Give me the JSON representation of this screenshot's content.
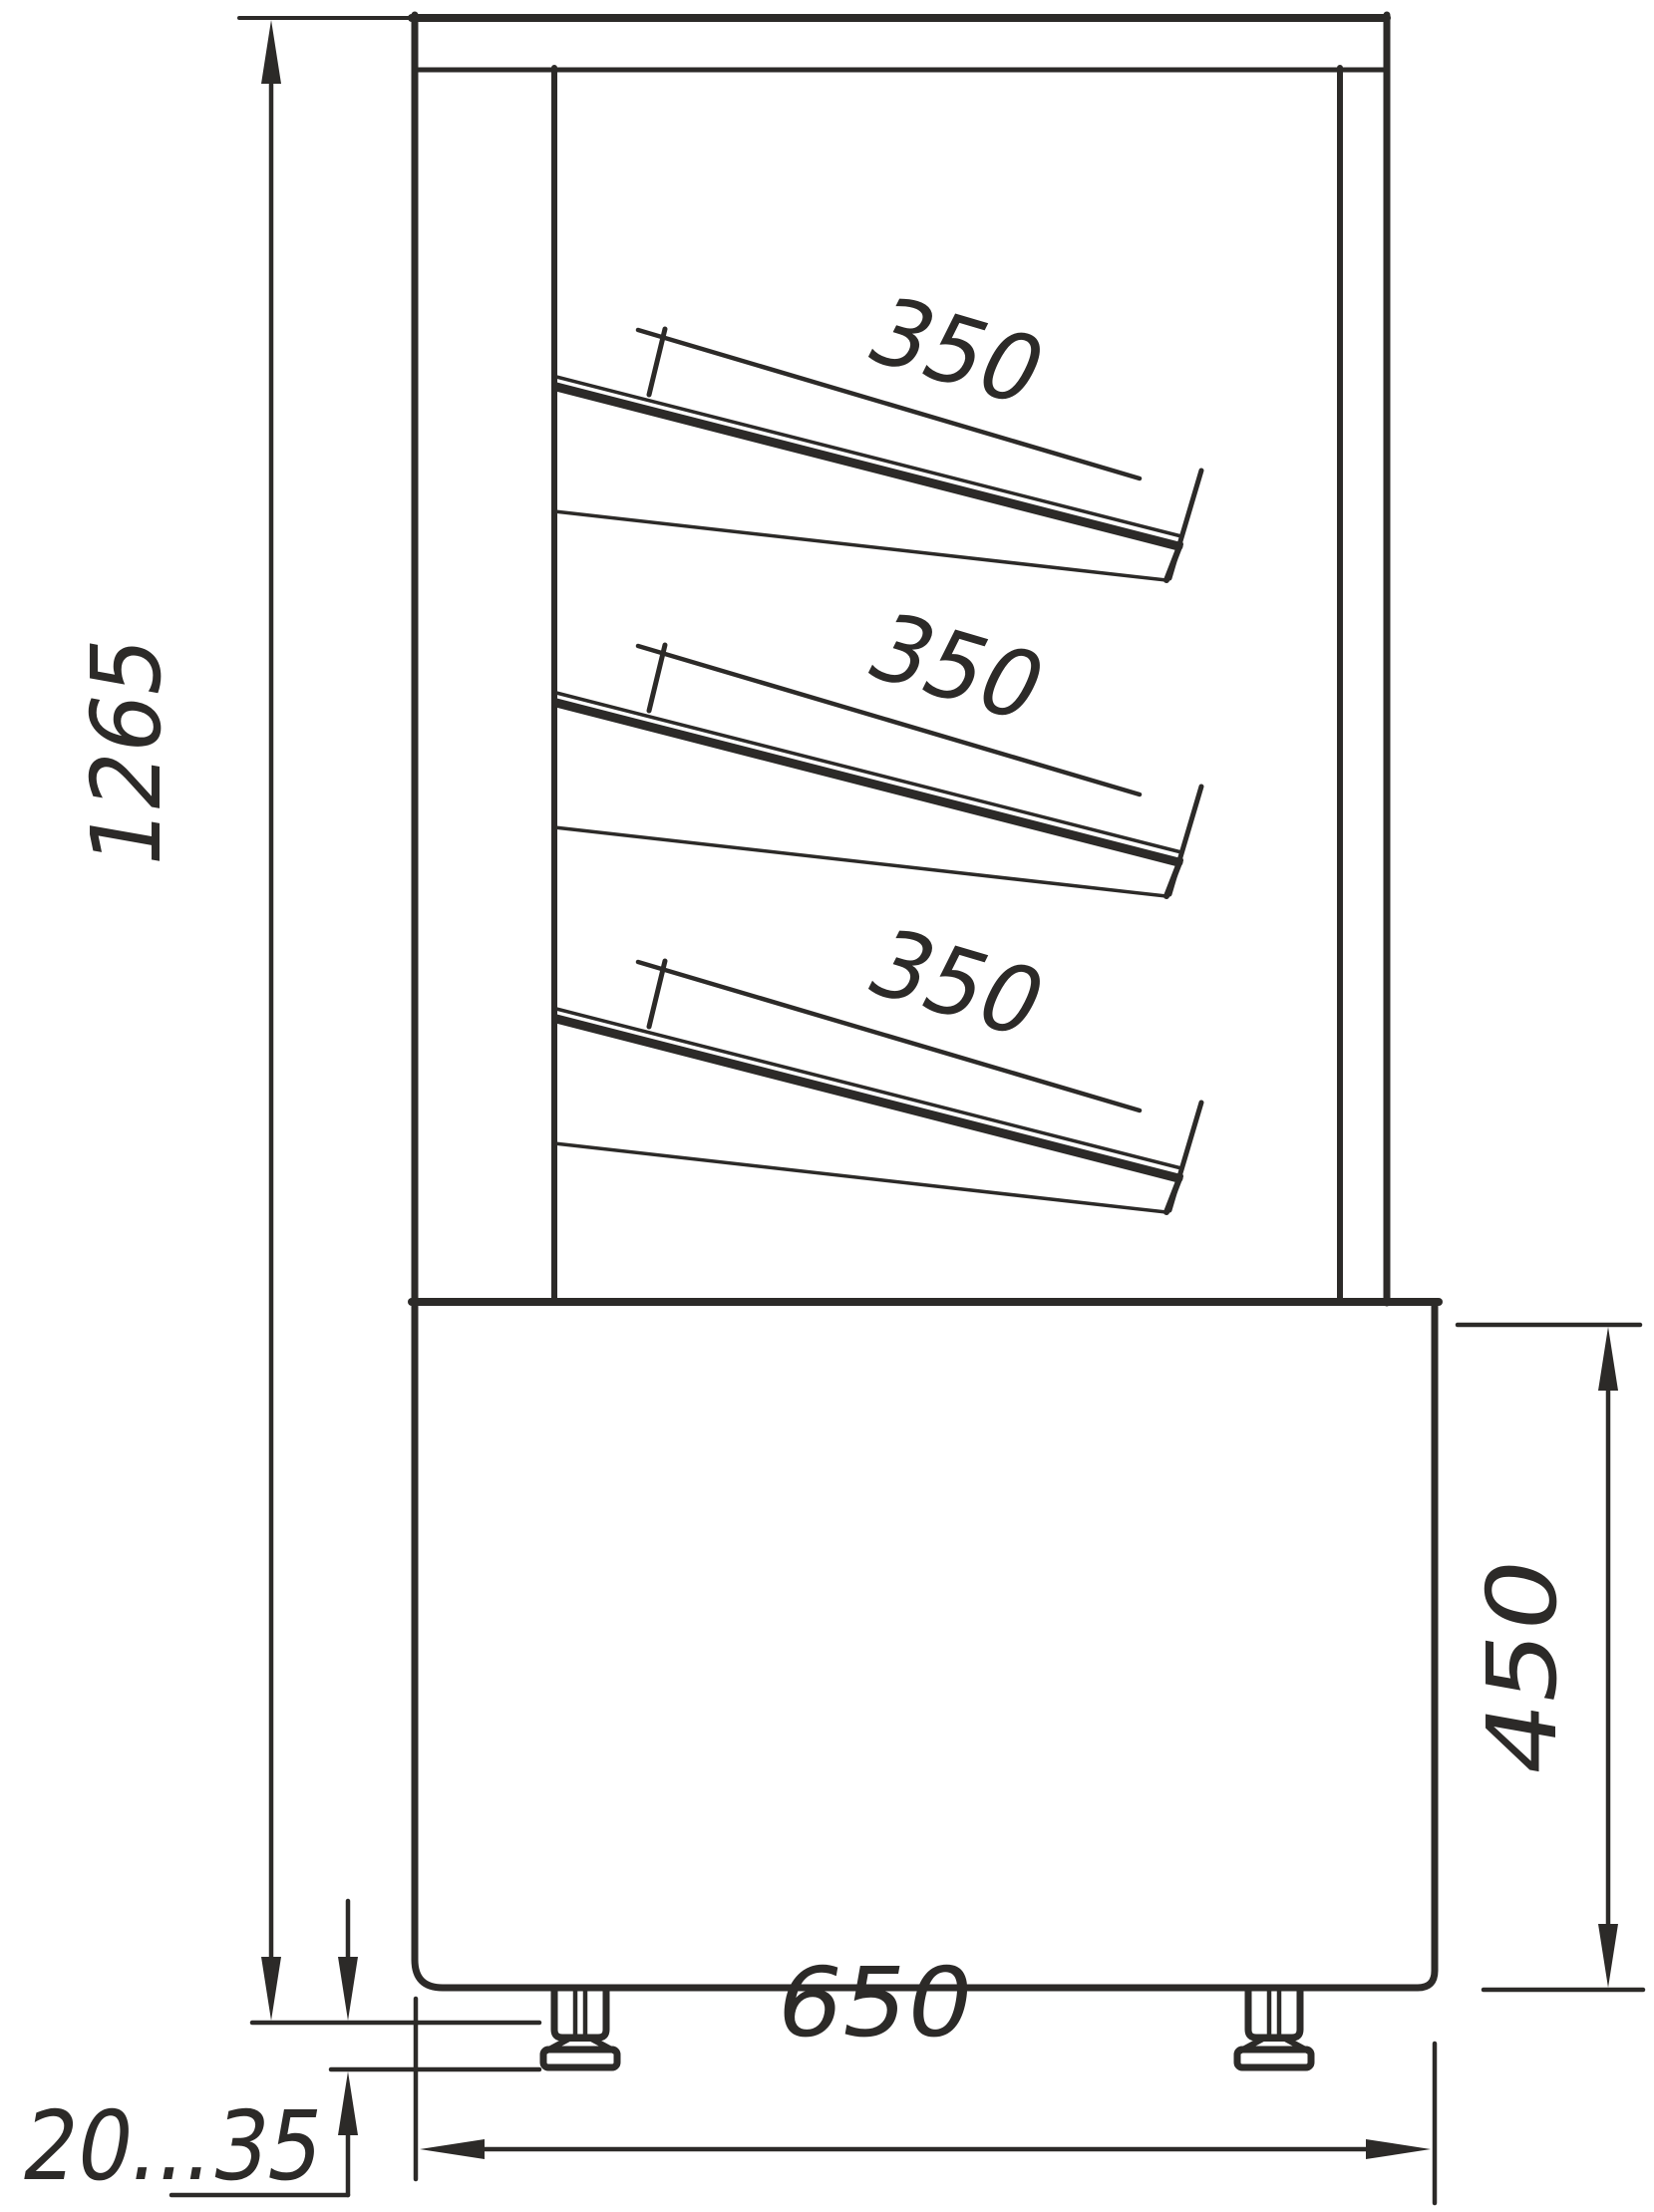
{
  "drawing": {
    "colors": {
      "ink": "#2c2a28",
      "background": "#ffffff"
    },
    "dimensions": {
      "overall_height": {
        "value": "1265"
      },
      "shelf_depths": [
        "350",
        "350",
        "350"
      ],
      "base_height": {
        "value": "450"
      },
      "base_width": {
        "value": "650"
      },
      "foot_adjust_range": {
        "value": "20...35"
      }
    }
  }
}
